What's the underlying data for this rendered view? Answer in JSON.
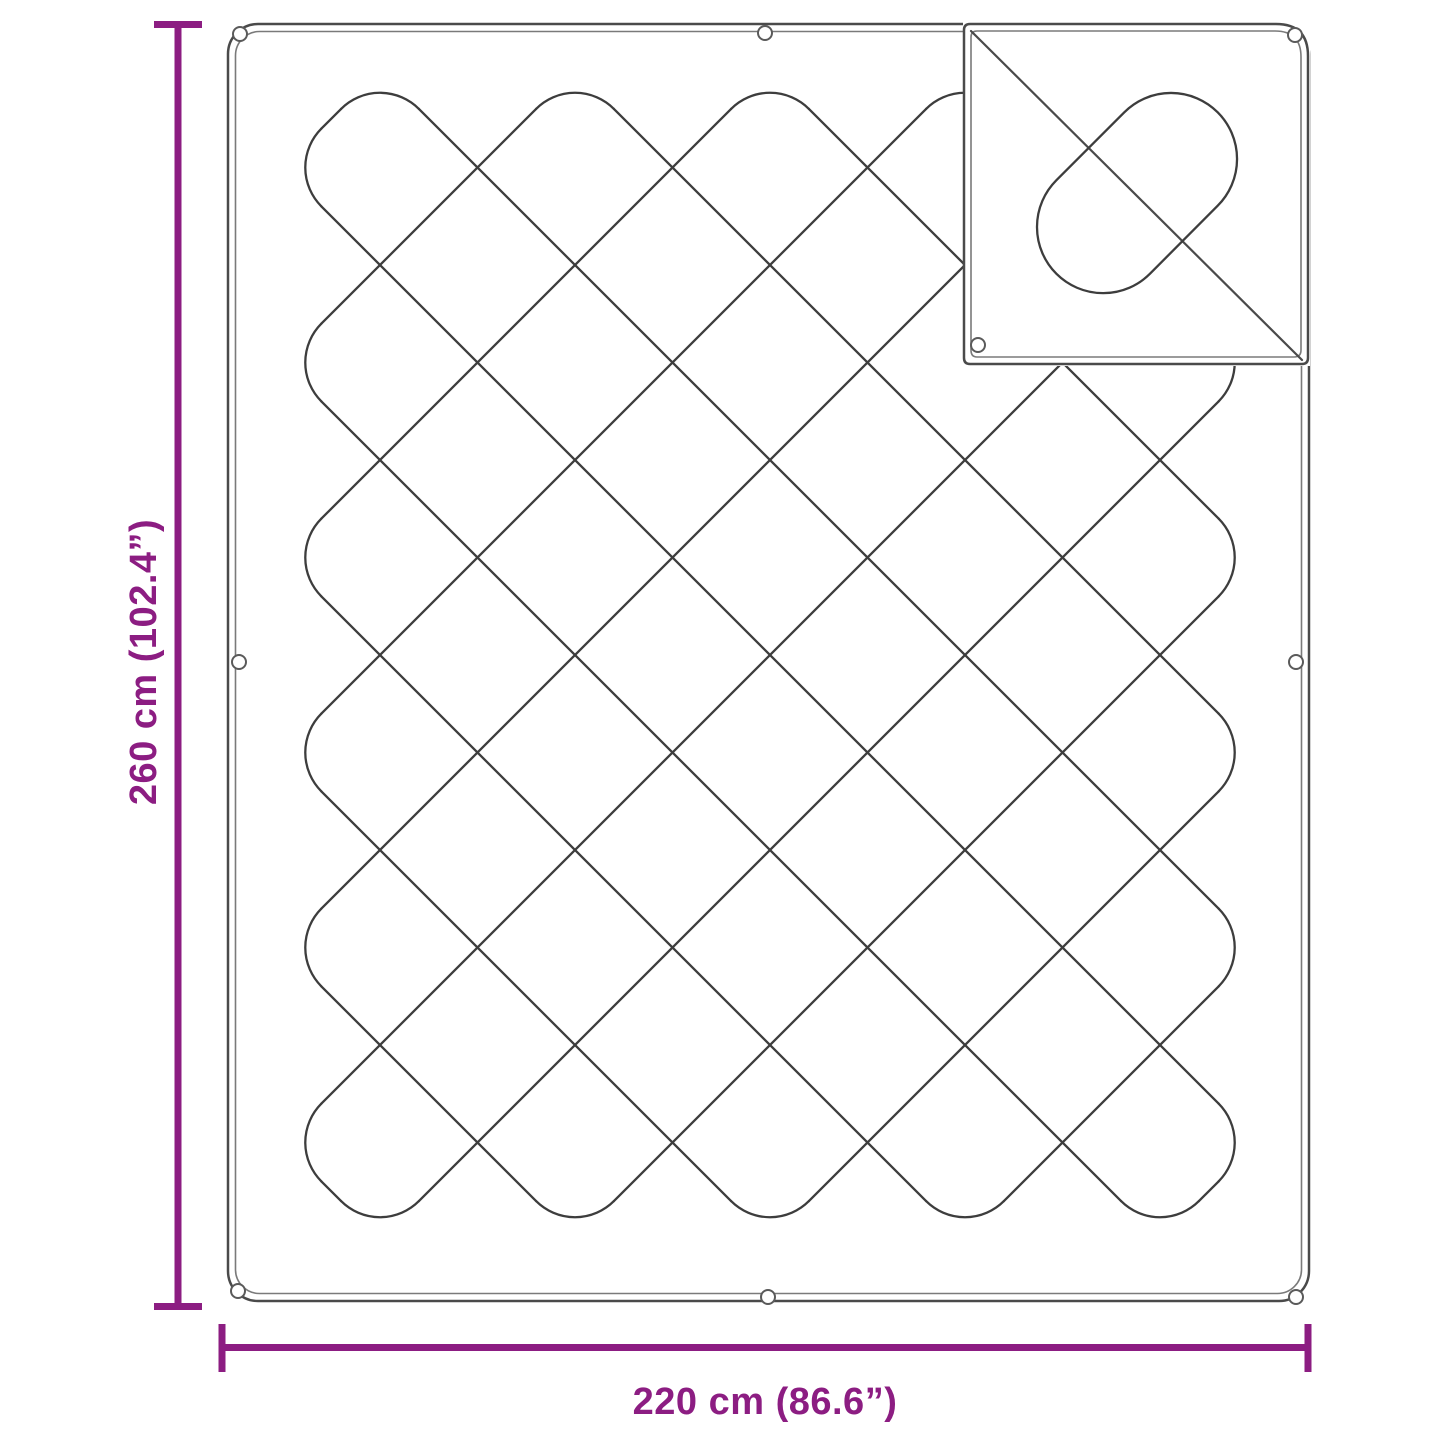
{
  "page": {
    "background": "#FFFFFF",
    "description": "Product dimension diagram of a quilted blanket with diamond stitching, snap buttons and a folded-over corner showing the reverse side"
  },
  "dimensions": {
    "height": {
      "label": "260 cm (102.4”)"
    },
    "width": {
      "label": "220 cm (86.6”)"
    }
  },
  "colors": {
    "accent": "#8C1D82",
    "stitch": "#3D3D3D",
    "outline": "#4A4A4A",
    "outline_inner": "#7A7A7A",
    "background": "#FFFFFF"
  },
  "icons": {
    "snap_button": "small hollow circle"
  }
}
